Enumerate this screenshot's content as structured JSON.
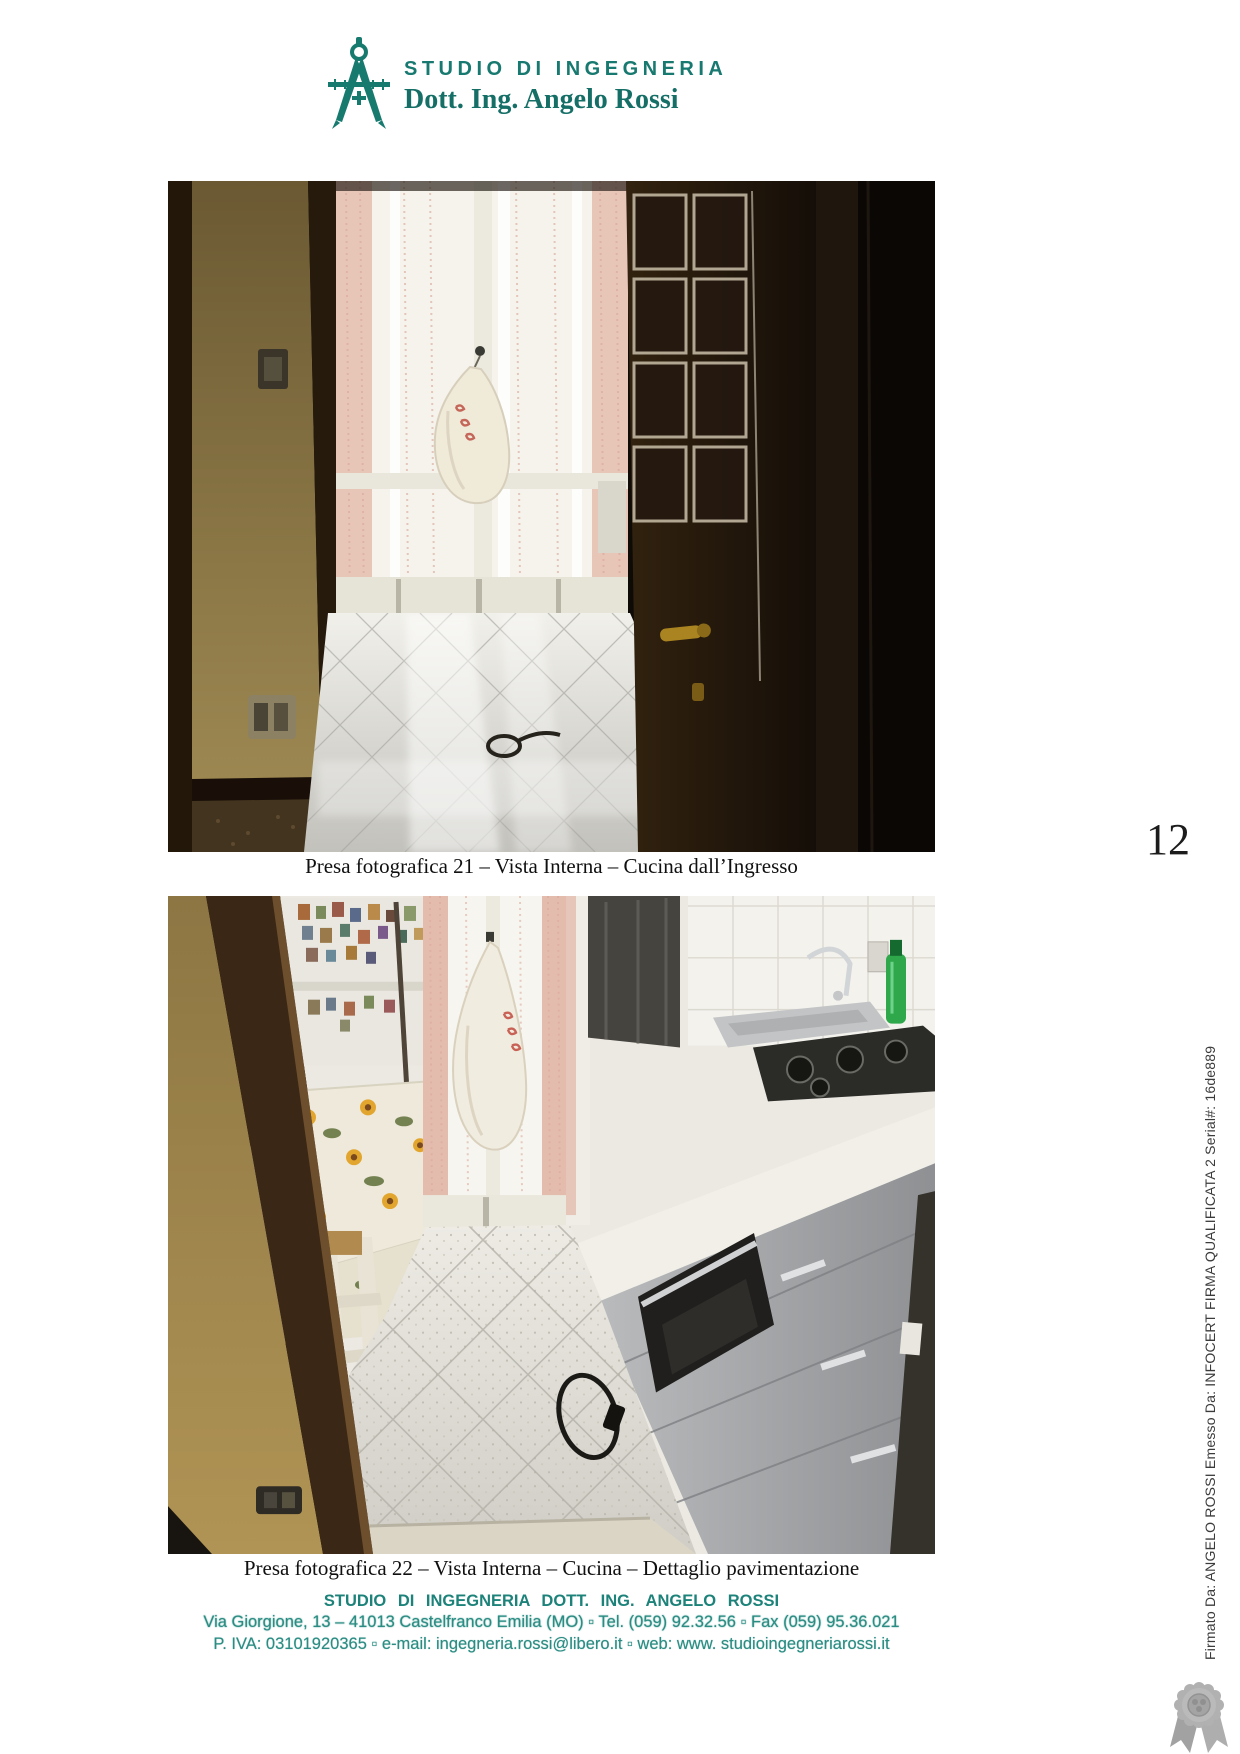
{
  "header": {
    "studio_line": "STUDIO DI INGEGNERIA",
    "name_line": "Dott. Ing. Angelo Rossi",
    "logo_icon": "drafting-compass-icon",
    "accent_color": "#17796f"
  },
  "page_number": "12",
  "photos": [
    {
      "id": "photo-21",
      "caption": "Presa fotografica 21 – Vista Interna – Cucina dall’Ingresso",
      "subject": "kitchen seen from entrance doorway"
    },
    {
      "id": "photo-22",
      "caption": "Presa fotografica 22 – Vista Interna – Cucina – Dettaglio pavimentazione",
      "subject": "kitchen floor tiling detail"
    }
  ],
  "footer": {
    "line1": "STUDIO DI INGEGNERIA DOTT. ING. ANGELO ROSSI",
    "line2": "Via Giorgione, 13 – 41013 Castelfranco Emilia (MO) ▫ Tel. (059) 92.32.56 ▫ Fax (059) 95.36.021",
    "line3": "P. IVA: 03101920365 ▫ e-mail: ingegneria.rossi@libero.it ▫ web: www. studioingegneriarossi.it"
  },
  "signature": {
    "vertical_text": "Firmato Da: ANGELO ROSSI Emesso Da: INFOCERT FIRMA QUALIFICATA 2 Serial#: 16de889",
    "seal_icon": "rosette-seal-icon"
  }
}
